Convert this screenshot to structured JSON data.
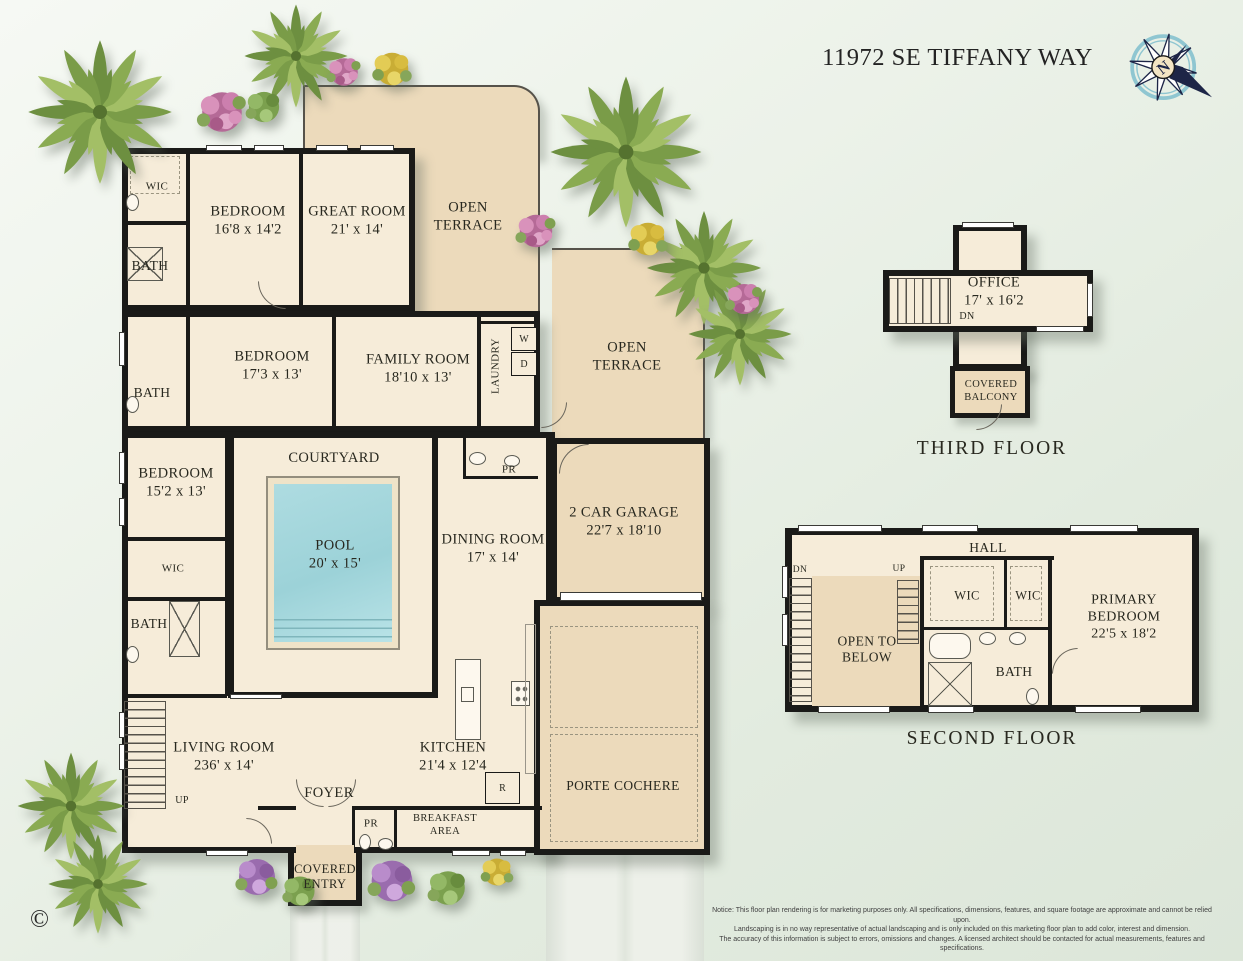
{
  "palette": {
    "background": "#e9f0e7",
    "floor_cream": "#f6ecd9",
    "terrace_tan": "#ecdabb",
    "wall_black": "#1a1a18",
    "pool_water": "#a8d8dd",
    "compass_navy": "#1d2547",
    "compass_teal": "#8fc6d1"
  },
  "header": {
    "title": "11972 SE TIFFANY WAY",
    "compass_n": "N"
  },
  "first_floor": {
    "wic_1": "WIC",
    "bath_1": "BATH",
    "bedroom_1": {
      "name": "BEDROOM",
      "dims": "16'8 x 14'2"
    },
    "great_room": {
      "name": "GREAT ROOM",
      "dims": "21' x 14'"
    },
    "open_terrace_1": {
      "line1": "OPEN",
      "line2": "TERRACE"
    },
    "bedroom_2": {
      "name": "BEDROOM",
      "dims": "17'3 x 13'"
    },
    "family_room": {
      "name": "FAMILY ROOM",
      "dims": "18'10 x 13'"
    },
    "laundry": "LAUNDRY",
    "washer": "W",
    "dryer": "D",
    "open_terrace_2": {
      "line1": "OPEN",
      "line2": "TERRACE"
    },
    "bath_2": "BATH",
    "bedroom_3": {
      "name": "BEDROOM",
      "dims": "15'2 x 13'"
    },
    "courtyard": "COURTYARD",
    "pool": {
      "name": "POOL",
      "dims": "20' x 15'"
    },
    "wic_2": "WIC",
    "bath_3": "BATH",
    "powder_1": "PR",
    "dining_room": {
      "name": "DINING ROOM",
      "dims": "17' x 14'"
    },
    "garage": {
      "name": "2 CAR GARAGE",
      "dims": "22'7 x 18'10"
    },
    "living_room": {
      "name": "LIVING ROOM",
      "dims": "236' x 14'"
    },
    "stairs_up": "UP",
    "kitchen": {
      "name": "KITCHEN",
      "dims": "21'4 x 12'4"
    },
    "refrigerator": "R",
    "foyer": "FOYER",
    "powder_2": "PR",
    "breakfast": {
      "line1": "BREAKFAST",
      "line2": "AREA"
    },
    "porte_cochere": "PORTE COCHERE",
    "covered_entry": {
      "line1": "COVERED",
      "line2": "ENTRY"
    }
  },
  "third_floor": {
    "office": {
      "name": "OFFICE",
      "dims": "17' x 16'2"
    },
    "stairs_dn": "DN",
    "covered_balcony": {
      "line1": "COVERED",
      "line2": "BALCONY"
    },
    "caption": "THIRD FLOOR"
  },
  "second_floor": {
    "hall": "HALL",
    "stairs_dn": "DN",
    "stairs_up": "UP",
    "open_to_below": {
      "line1": "OPEN TO",
      "line2": "BELOW"
    },
    "wic_a": "WIC",
    "wic_b": "WIC",
    "primary_bedroom": {
      "name1": "PRIMARY",
      "name2": "BEDROOM",
      "dims": "22'5 x 18'2"
    },
    "bath": "BATH",
    "caption": "SECOND FLOOR"
  },
  "footer": {
    "copyright": "©",
    "notice_label": "Notice:",
    "notice_line1": "This floor plan rendering is for marketing purposes only. All specifications, dimensions, features, and square footage are approximate and cannot be relied upon.",
    "notice_line2": "Landscaping is in no way representative of actual landscaping and is only included on this marketing floor plan to add color, interest and dimension.",
    "notice_line3": "The accuracy of this information is subject to errors, omissions and changes. A licensed architect should be contacted for actual measurements, features and specifications."
  }
}
